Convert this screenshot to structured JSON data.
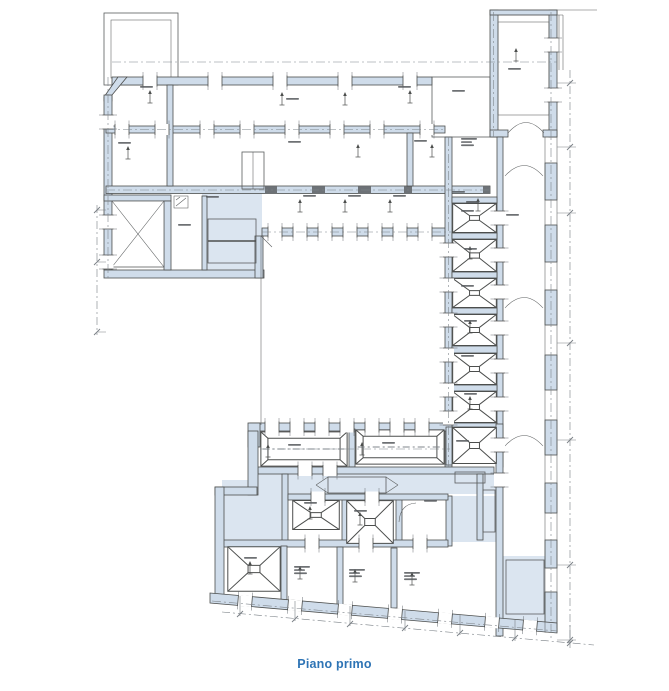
{
  "caption": {
    "text": "Piano primo"
  },
  "figure": {
    "kind": "architectural-floor-plan",
    "floor": "Piano primo"
  },
  "theme": {
    "paper": "#ffffff",
    "wall": "#cfdcea",
    "circ": "#dbe5f0",
    "line": "#4c4e4d",
    "axis": "#7f858b",
    "dark": "#6d7277",
    "dim": "#7a8086",
    "lbl": "#55585c",
    "caption": "#2E74B5"
  }
}
